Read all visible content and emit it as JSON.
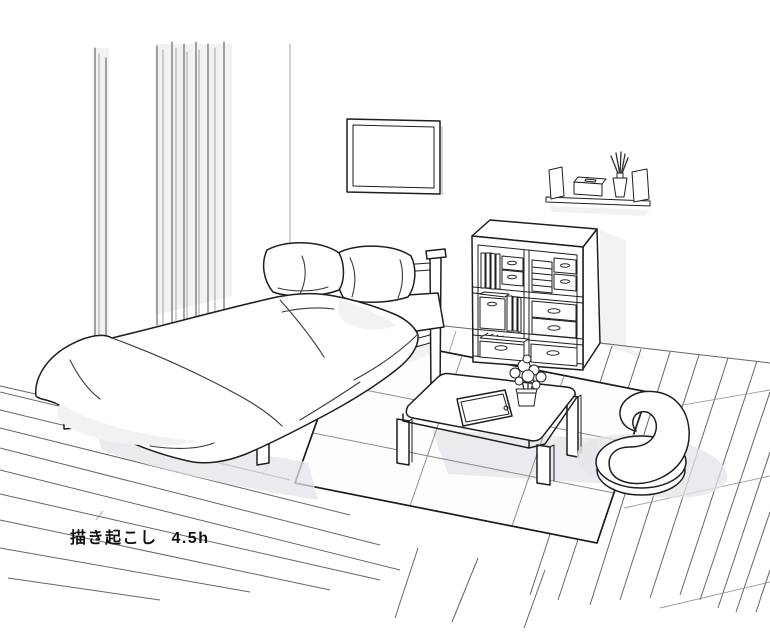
{
  "caption": {
    "text": "描き起こし 4.5h"
  },
  "scene": {
    "objects": [
      "curtains",
      "wall-corner",
      "picture-frame",
      "wall-shelf",
      "tissue-box",
      "reed-diffuser",
      "bed",
      "pillows",
      "duvet",
      "headboard",
      "bed-legs",
      "cube-shelf",
      "books",
      "storage-boxes",
      "drawers",
      "towel-stack",
      "low-table",
      "tablet",
      "flower-pot",
      "rug",
      "floor-chair",
      "wood-floor"
    ]
  },
  "colors": {
    "background": "#ffffff",
    "ink": "#1e1e1e",
    "floor_line": "#555555",
    "shadow": "#e4e4ea",
    "shade": "#f2f2f5",
    "rug": "#fdfdfe"
  }
}
